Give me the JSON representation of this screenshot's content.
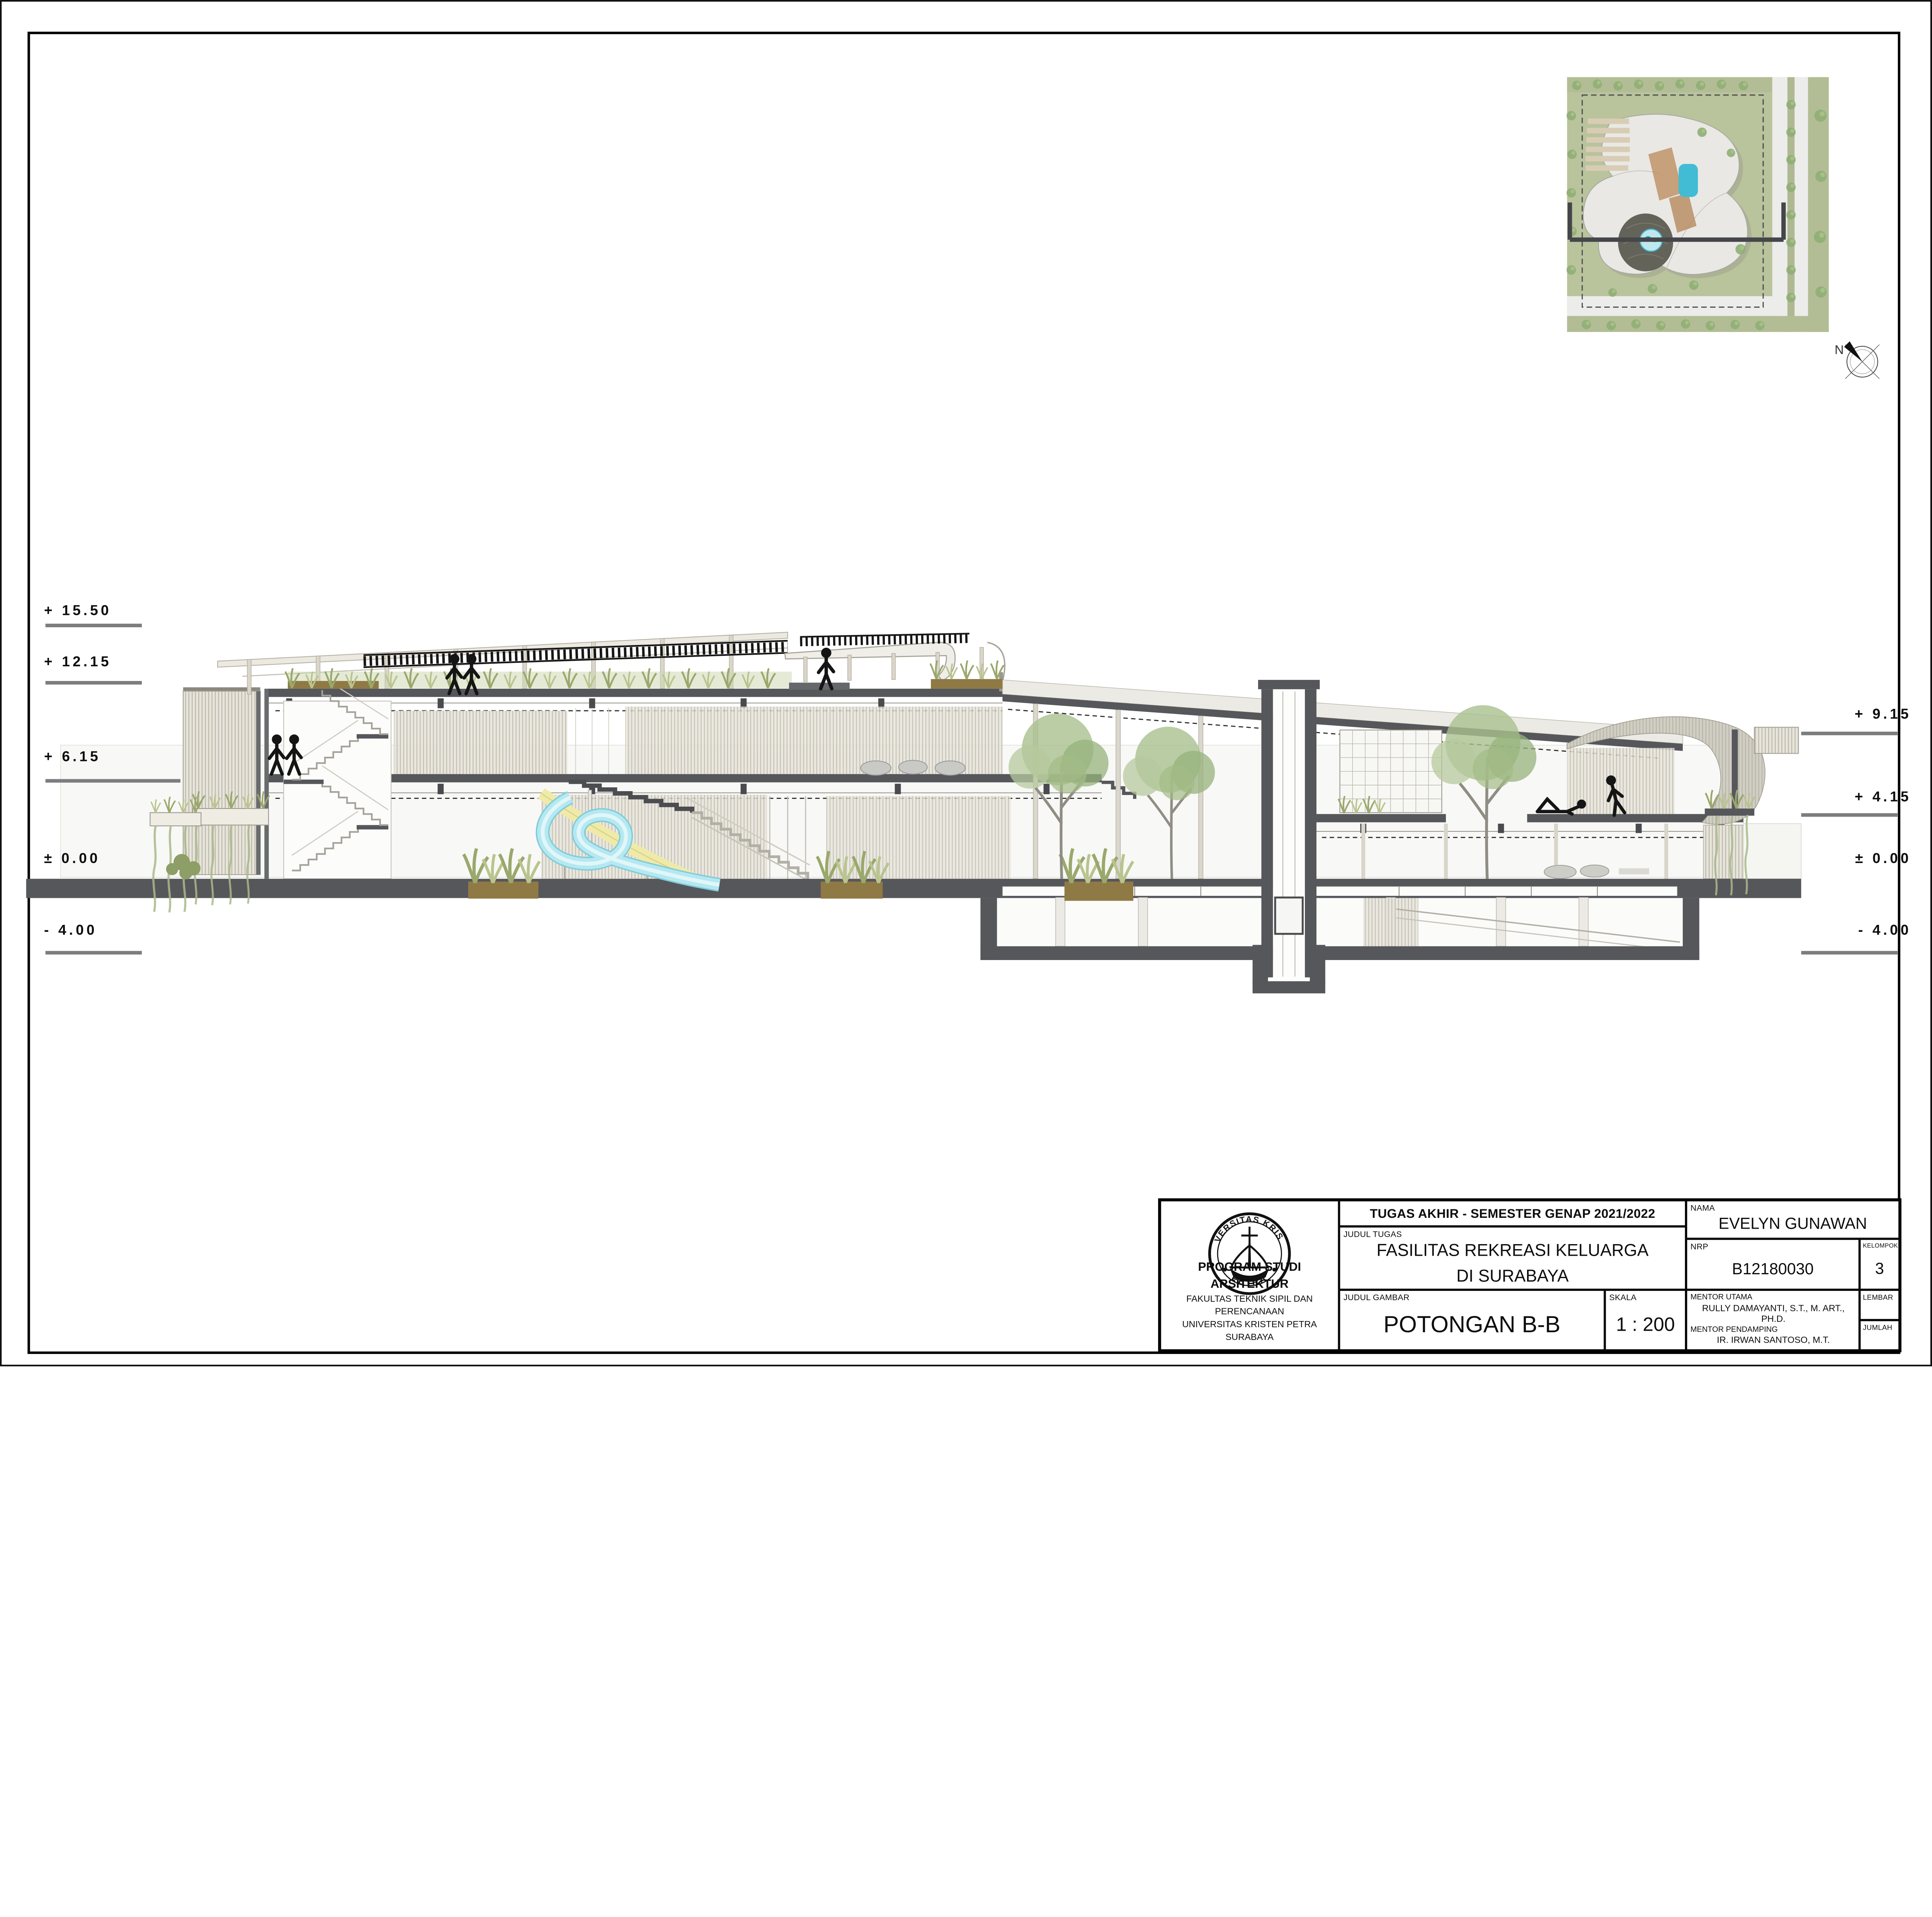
{
  "sheet": {
    "drawing_title": "POTONGAN B-B",
    "scale_value": "1 : 200"
  },
  "elevation_markers": {
    "left": [
      "+ 15.50",
      "+ 12.15",
      "+ 6.15",
      "± 0.00",
      "- 4.00"
    ],
    "right": [
      "+ 9.15",
      "+ 4.15",
      "± 0.00",
      "- 4.00"
    ]
  },
  "key_plan": {
    "north_label": "N"
  },
  "title_block": {
    "header": "TUGAS AKHIR - SEMESTER GENAP 2021/2022",
    "labels": {
      "judul_tugas": "JUDUL TUGAS",
      "judul_gambar": "JUDUL GAMBAR",
      "skala": "SKALA",
      "nama": "NAMA",
      "nrp": "NRP",
      "kelompok": "KELOMPOK",
      "mentor_utama": "MENTOR UTAMA",
      "mentor_pendamping": "MENTOR PENDAMPING",
      "lembar": "LEMBAR",
      "jumlah": "JUMLAH"
    },
    "judul_tugas_line1": "FASILITAS REKREASI KELUARGA",
    "judul_tugas_line2": "DI SURABAYA",
    "judul_gambar": "POTONGAN B-B",
    "skala": "1 : 200",
    "nama": "EVELYN GUNAWAN",
    "nrp": "B12180030",
    "kelompok": "3",
    "mentor_utama": "RULLY DAMAYANTI, S.T., M. ART., PH.D.",
    "mentor_pendamping": [
      "IR. IRWAN SANTOSO, M.T.",
      "IR. SAMUELHARTONO, M. SC.",
      "ELVINA S. WIJAYA, S.T., M.T."
    ],
    "institution": {
      "line1": "PROGRAM STUDI ARSITEKTUR",
      "line2": "FAKULTAS TEKNIK SIPIL DAN PERENCANAAN",
      "line3": "UNIVERSITAS KRISTEN PETRA",
      "line4": "SURABAYA"
    },
    "logo_text_top": "UNIVERSITAS KRISTEN",
    "logo_text_bottom": "PETRA"
  },
  "colors": {
    "cut_poche": "#56575b",
    "marker_line": "#7c7d7f",
    "louver_beige": "#bdb9ab",
    "grass_green": "#9aa86c",
    "grass_light": "#b9c48e",
    "soil_brown": "#8f7a45",
    "tree_green": "#a9c08f",
    "pool_cyan": "#7fccdb",
    "slide_yellow": "#f0eaa8",
    "site_green": "#b9c39c",
    "deck_tan": "#c09468",
    "figure_black": "#151515"
  }
}
